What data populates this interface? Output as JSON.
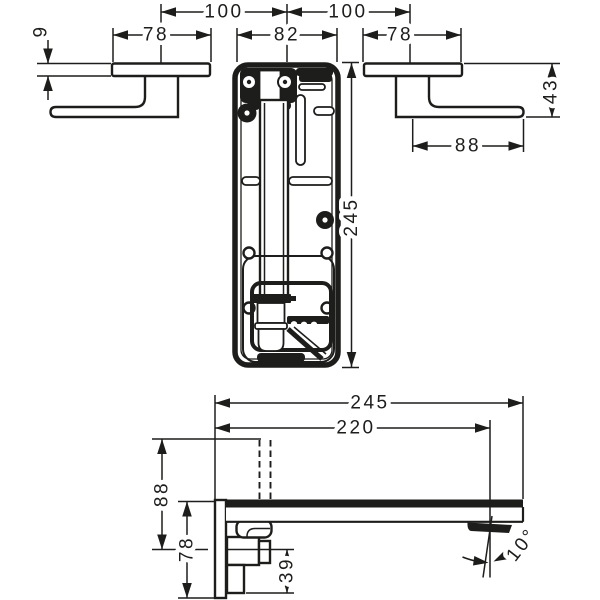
{
  "colors": {
    "line": "#1d1d1b",
    "background": "#ffffff"
  },
  "views": {
    "top": {
      "dims": {
        "span_left": "100",
        "span_right": "100",
        "handle_plate_left": "78",
        "body_width": "82",
        "handle_plate_right": "78",
        "plate_thickness": "9",
        "handle_height": "43",
        "handle_reach": "88",
        "body_height": "245"
      }
    },
    "side": {
      "dims": {
        "total_depth": "245",
        "spout_reach": "220",
        "riser_height": "88",
        "escutcheon_height": "78",
        "outlet_drop": "39",
        "spray_angle": "10°"
      }
    }
  }
}
